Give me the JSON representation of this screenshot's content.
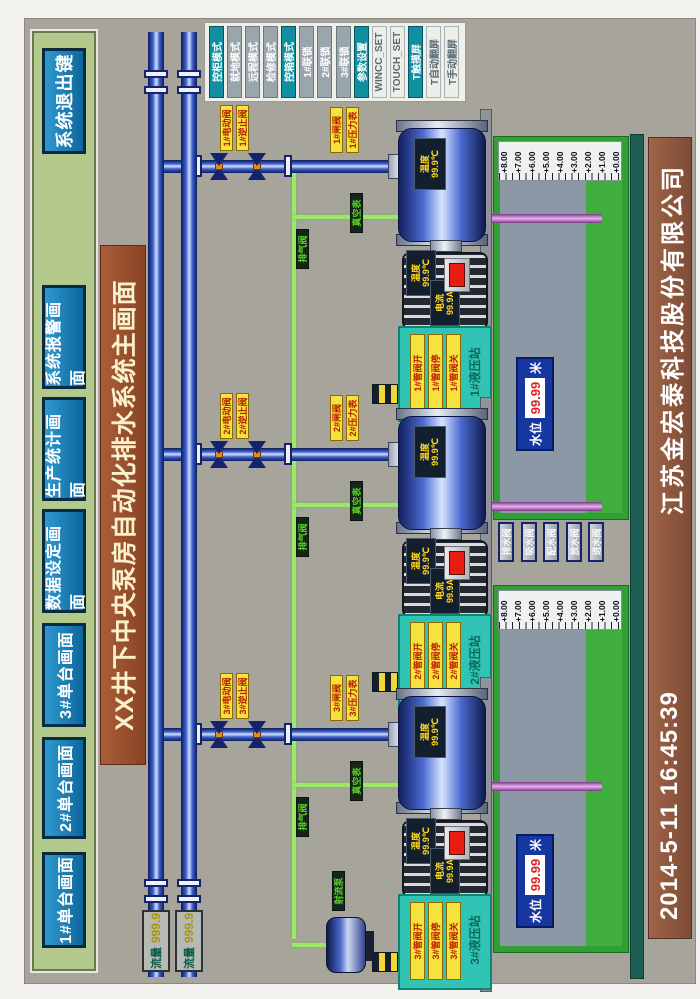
{
  "topbar": {
    "buttons": [
      "1#单台画面",
      "2#单台画面",
      "3#单台画面",
      "数据设定画面",
      "生产统计画面",
      "系统报警画面",
      "系统退出键"
    ]
  },
  "title": {
    "text": "XX井下中央泵房自动化排水系统主画面"
  },
  "right_panel": {
    "buttons": [
      {
        "label": "控柜模式"
      },
      {
        "label": "就地模式"
      },
      {
        "label": "远程模式"
      },
      {
        "label": "检修模式"
      },
      {
        "label": "控箱模式"
      },
      {
        "label": "1#联锁"
      },
      {
        "label": "2#联锁"
      },
      {
        "label": "3#联锁"
      },
      {
        "label": "参数设置"
      },
      {
        "label": "WINCC_SET"
      },
      {
        "label": "TOUCH_SET"
      },
      {
        "label": "T触摸屏"
      },
      {
        "label": "T自动翻屏"
      },
      {
        "label": "T手动翻屏"
      }
    ]
  },
  "bottom_bar": {
    "datetime": "2014-5-11  16:45:39",
    "company": "江苏金宏泰科技股份有限公司"
  },
  "flow_meters": [
    {
      "label": "流量",
      "value": "999.9"
    },
    {
      "label": "流量",
      "value": "999.9"
    }
  ],
  "assemblies": [
    {
      "id": "1#",
      "valve_tag_a": "1#电动阀",
      "valve_tag_b": "1#逆止阀",
      "valve_tag_c": "1#闸阀",
      "valve_tag_d": "1#压力表",
      "green_tag_a": "排气阀",
      "green_tag_b": "真空表",
      "pump_temp_label": "温度",
      "pump_temp": "99.9℃",
      "motor_temp_label": "温度",
      "motor_temp": "99.9℃",
      "motor_current_label": "电流",
      "motor_current": "99.9A",
      "hydraulic": {
        "tag1": "1#管阀开",
        "tag2": "1#管阀停",
        "tag3": "1#管阀关",
        "station": "1#液压站"
      }
    },
    {
      "id": "2#",
      "valve_tag_a": "2#电动阀",
      "valve_tag_b": "2#逆止阀",
      "valve_tag_c": "2#闸阀",
      "valve_tag_d": "2#压力表",
      "green_tag_a": "排气阀",
      "green_tag_b": "真空表",
      "pump_temp_label": "温度",
      "pump_temp": "99.9℃",
      "motor_temp_label": "温度",
      "motor_temp": "99.9℃",
      "motor_current_label": "电流",
      "motor_current": "99.9A",
      "hydraulic": {
        "tag1": "2#管阀开",
        "tag2": "2#管阀停",
        "tag3": "2#管阀关",
        "station": "2#液压站"
      }
    },
    {
      "id": "3#",
      "valve_tag_a": "3#电动阀",
      "valve_tag_b": "3#逆止阀",
      "valve_tag_c": "3#闸阀",
      "valve_tag_d": "3#压力表",
      "green_tag_a": "排气阀",
      "green_tag_b": "真空表",
      "pump_temp_label": "温度",
      "pump_temp": "99.9℃",
      "motor_temp_label": "温度",
      "motor_temp": "99.9℃",
      "motor_current_label": "电流",
      "motor_current": "99.9A",
      "hydraulic": {
        "tag1": "3#管阀开",
        "tag2": "3#管阀停",
        "tag3": "3#管阀关",
        "station": "3#液压站"
      }
    }
  ],
  "tanks": [
    {
      "scale": [
        "+8.00",
        "+7.00",
        "+6.00",
        "+5.00",
        "+4.00",
        "+3.00",
        "+2.00",
        "+1.00",
        "+0.00"
      ],
      "level": {
        "label": "水位",
        "value": "99.99",
        "unit": "米"
      }
    },
    {
      "scale": [
        "+8.00",
        "+7.00",
        "+6.00",
        "+5.00",
        "+4.00",
        "+3.00",
        "+2.00",
        "+1.00",
        "+0.00"
      ],
      "level": {
        "label": "水位",
        "value": "99.99",
        "unit": "米"
      }
    }
  ],
  "sump_buttons": [
    "排水阀",
    "吸水阀",
    "配水阀",
    "放水阀",
    "进水阀"
  ],
  "jet_pump_label": "射流泵"
}
